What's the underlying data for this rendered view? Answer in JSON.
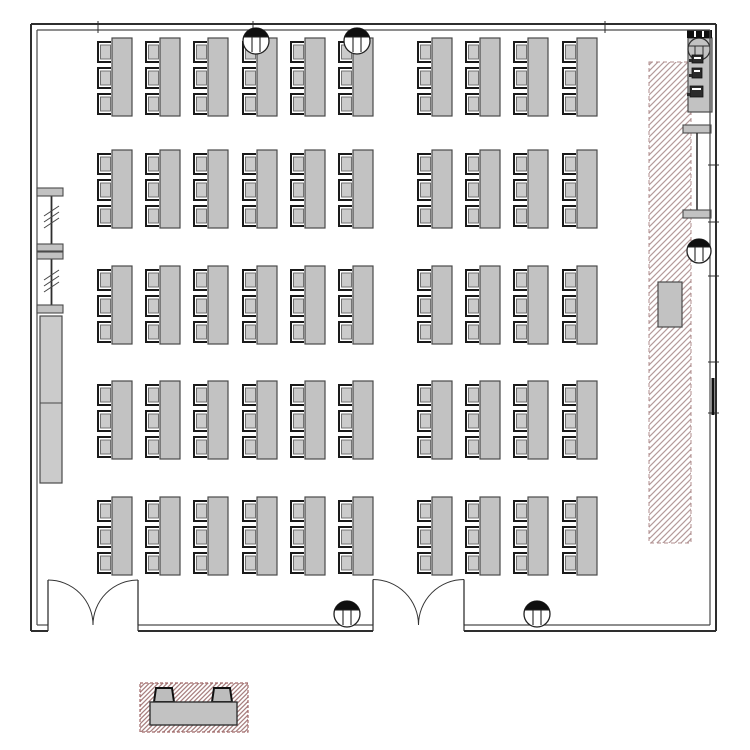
{
  "meta": {
    "type": "floor-plan",
    "description": "Classroom / exam-hall floor plan: 5 rows x 10 columns of three-seat desks (50 desks, 150 seats), two double entrance doors on the bottom wall, hatched service strip with counter along the right wall, folding partition and tall cabinet on the left wall, and a hatched desk-detail legend below the plan",
    "canvas": {
      "w": 750,
      "h": 750
    }
  },
  "colors": {
    "background": "#ffffff",
    "wall": "#2e2e2e",
    "wall_inner": "#4a4a4a",
    "furniture_fill": "#c2c2c2",
    "furniture_fill_light": "#cbcbcb",
    "furniture_stroke": "#4a4a4a",
    "chair_bracket": "#1a1a1a",
    "hatch_line": "#b49a9a",
    "hatch_border": "#b08c8c",
    "legend_hatch_line": "#a88080",
    "legend_border": "#a06868",
    "symbol_dark": "#0f0f0f"
  },
  "room": {
    "outer": {
      "x1": 31,
      "y1": 24,
      "x2": 716,
      "y2": 631
    },
    "inner": {
      "x1": 37,
      "y1": 30,
      "x2": 710,
      "y2": 625
    },
    "door_openings": [
      {
        "x1": 48,
        "x2": 138,
        "y": 625,
        "label": "double-door-left"
      },
      {
        "x1": 373,
        "x2": 464,
        "y": 625,
        "label": "double-door-center"
      }
    ],
    "top_wall_ticks_x": [
      98,
      253,
      605
    ],
    "right_wall_ticks_y": [
      165,
      222,
      276,
      362,
      413
    ],
    "right_wall_dark_segment": {
      "x": 713,
      "y1": 378,
      "y2": 415
    }
  },
  "desks": {
    "rows_y": [
      38,
      150,
      266,
      381,
      497
    ],
    "cols_x": [
      97,
      145,
      193,
      242,
      290,
      338,
      417,
      465,
      513,
      562
    ],
    "chair_w": 14,
    "chair_h": 20,
    "chair_pitch": 26,
    "table_w": 20,
    "table_h": 78,
    "chairs_per_desk": 3,
    "desk_count": 50,
    "seat_count": 150
  },
  "columns": [
    {
      "cx": 256,
      "cy": 41,
      "r": 13
    },
    {
      "cx": 357,
      "cy": 41,
      "r": 13
    },
    {
      "cx": 347,
      "cy": 614,
      "r": 13
    },
    {
      "cx": 537,
      "cy": 614,
      "r": 13
    },
    {
      "cx": 699,
      "cy": 251,
      "r": 12
    }
  ],
  "fan_unit": {
    "cx": 699,
    "cy": 49,
    "r": 11
  },
  "service_strip": {
    "x": 649,
    "y": 62,
    "w": 42,
    "h": 481
  },
  "counter_area": {
    "vent_bar": {
      "x": 687,
      "y": 30,
      "w": 25,
      "h": 8
    },
    "vent_slits_x": [
      694,
      702
    ],
    "counter": {
      "x": 688,
      "y": 38,
      "w": 24,
      "h": 74
    },
    "appliances": [
      {
        "x": 692,
        "y": 55,
        "w": 11,
        "h": 8
      },
      {
        "x": 692,
        "y": 68,
        "w": 10,
        "h": 10
      },
      {
        "x": 690,
        "y": 86,
        "w": 13,
        "h": 11
      }
    ],
    "shelf_bar_top": {
      "x": 683,
      "y": 125,
      "w": 28,
      "h": 8
    },
    "shelf_post": {
      "x": 697,
      "y1": 133,
      "y2": 210
    },
    "shelf_bar_bottom": {
      "x": 683,
      "y": 210,
      "w": 28,
      "h": 8
    },
    "equipment_box": {
      "x": 658,
      "y": 282,
      "w": 24,
      "h": 45
    }
  },
  "partition_left": {
    "bars": [
      {
        "x": 37,
        "y": 188,
        "w": 26,
        "h": 8
      },
      {
        "x": 37,
        "y": 244,
        "w": 26,
        "h": 7
      },
      {
        "x": 37,
        "y": 252,
        "w": 26,
        "h": 7
      },
      {
        "x": 37,
        "y": 305,
        "w": 26,
        "h": 8
      }
    ],
    "post_x": 51.5,
    "post_y1": 196,
    "post_y2": 305,
    "tick_group_centers_y": [
      216,
      280
    ],
    "ticks_per_group": 3
  },
  "cabinet_left": {
    "x": 40,
    "y": 316,
    "w": 22,
    "h": 167,
    "divider_y": 403
  },
  "legend": {
    "box": {
      "x": 140,
      "y": 683,
      "w": 108,
      "h": 49
    },
    "table": {
      "x": 150,
      "y": 702,
      "w": 87,
      "h": 23
    },
    "chairs": [
      {
        "x1": 154,
        "x2": 174,
        "y_base": 702,
        "y_top": 688,
        "inset": 2
      },
      {
        "x1": 212,
        "x2": 232,
        "y_base": 702,
        "y_top": 688,
        "inset": 2
      }
    ]
  }
}
